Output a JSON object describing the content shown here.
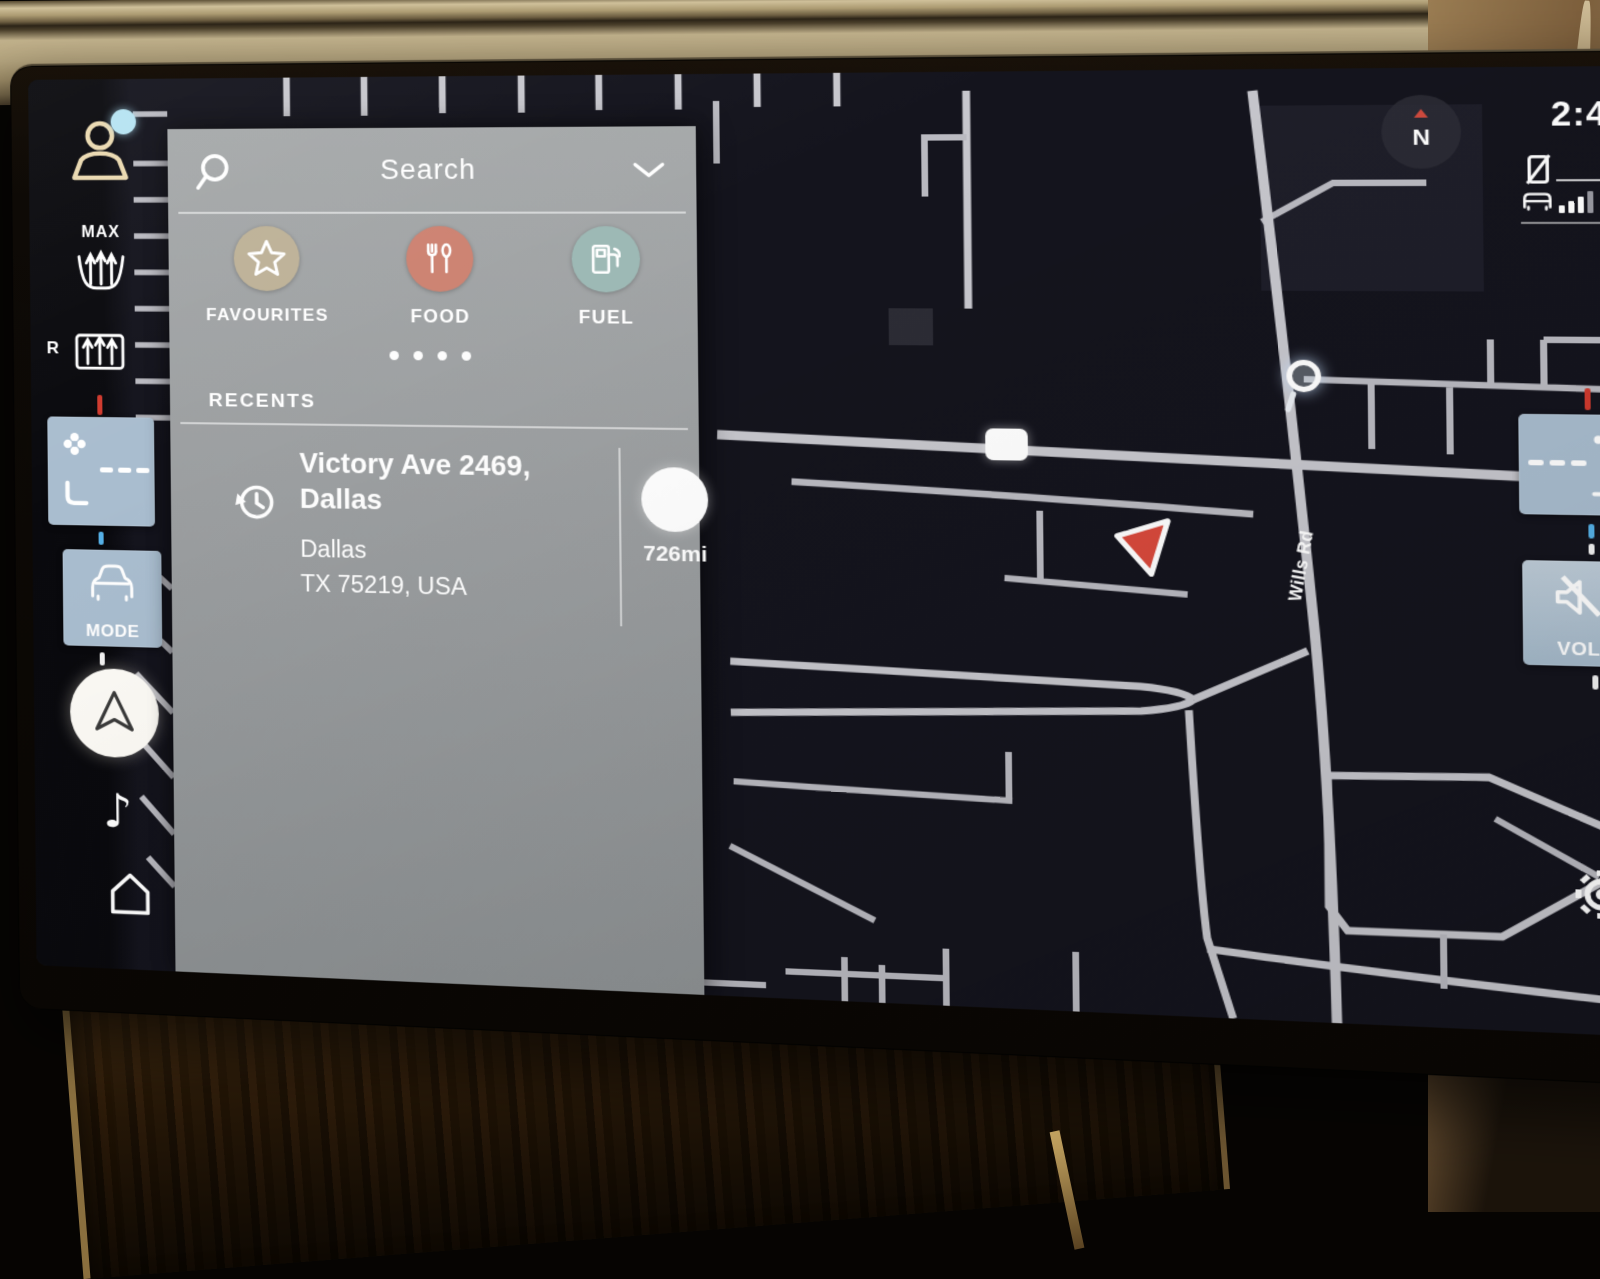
{
  "window": {
    "type": "car-infotainment-navigation"
  },
  "status_bar": {
    "time": "2:44",
    "network": "4G",
    "compass_label": "N"
  },
  "search_panel": {
    "header": {
      "title": "Search",
      "search_icon": "magnifier-icon",
      "collapse_icon": "chevron-down-icon"
    },
    "categories": [
      {
        "label": "FAVOURITES",
        "icon": "star-icon",
        "circle_color": "#beb298"
      },
      {
        "label": "FOOD",
        "icon": "utensils-icon",
        "circle_color": "#cd8372"
      },
      {
        "label": "FUEL",
        "icon": "fuel-pump-icon",
        "circle_color": "#9db9b5"
      }
    ],
    "pagination": {
      "dots": 4,
      "active_dot": 1
    },
    "recents": {
      "label": "RECENTS",
      "items": [
        {
          "icon": "clock-history-icon",
          "title": "Victory Ave 2469, Dallas",
          "line2": "Dallas",
          "line3": "TX 75219, USA",
          "distance": "726mi"
        }
      ]
    }
  },
  "left_rail": {
    "profile": {
      "icon": "profile-icon",
      "notification": true
    },
    "max_defrost": {
      "label": "MAX",
      "icon": "front-defrost-icon"
    },
    "rear_defrost": {
      "label": "R",
      "icon": "rear-defrost-icon"
    },
    "seat_climate": {
      "icons": [
        "fan-icon",
        "seat-icon"
      ],
      "level": "- - -"
    },
    "mode": {
      "label": "MODE",
      "icon": "car-icon"
    },
    "nav": {
      "icon": "nav-arrow-icon"
    },
    "media": {
      "icon": "music-note-icon",
      "glyph": "♪"
    },
    "home": {
      "icon": "home-icon"
    }
  },
  "right_rail": {
    "seat_climate": {
      "icons": [
        "fan-icon",
        "seat-icon"
      ],
      "level": "- - -"
    },
    "volume": {
      "label": "VOL",
      "icon": "speaker-mute-icon"
    },
    "settings": {
      "icon": "gear-icon"
    }
  },
  "map": {
    "style": "night",
    "background_color": "#14141d",
    "road_color": "#c7c7cd",
    "road_label": "Wills Rd",
    "vehicle_marker_color": "#d8493c",
    "markers": [
      "road-sign-marker",
      "poi-circle-marker",
      "vehicle-arrow-marker"
    ]
  },
  "colors": {
    "panel_gray": "#9ea1a3",
    "button_blue": "#a9bdcf",
    "accent_red": "#d03a2e",
    "tick_blue": "#55b0e6",
    "profile_cream": "#ead9b0",
    "notification_cyan": "#b6e3f2"
  }
}
